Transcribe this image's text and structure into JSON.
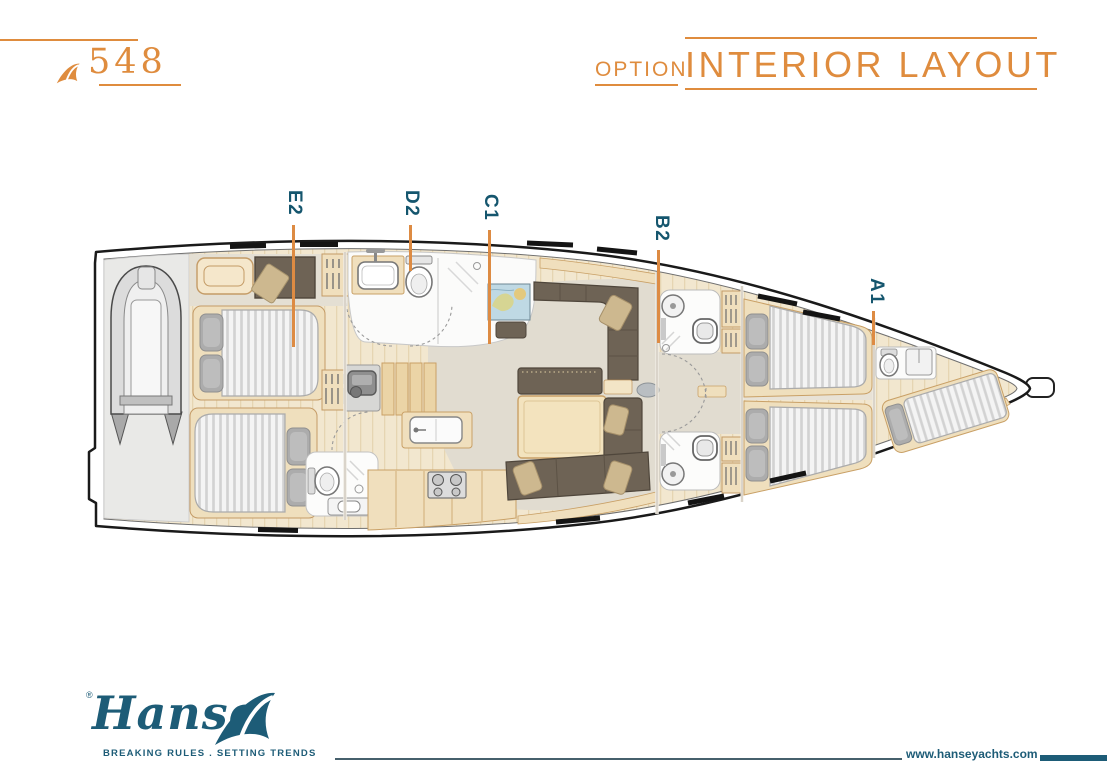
{
  "header": {
    "model": "548",
    "option_label": "OPTION",
    "title": "INTERIOR LAYOUT"
  },
  "plan": {
    "cabin_labels": [
      {
        "code": "E2"
      },
      {
        "code": "D2"
      },
      {
        "code": "C1"
      },
      {
        "code": "B2"
      },
      {
        "code": "A1"
      }
    ]
  },
  "footer": {
    "brand": "Hanse",
    "registered_mark": "®",
    "tagline": "BREAKING RULES . SETTING TRENDS",
    "website": "www.hanseyachts.com"
  },
  "colors": {
    "accent_orange": "#DF8C3E",
    "leader_orange": "#DD8B43",
    "brand_teal": "#1D5C77",
    "label_teal": "#15566E",
    "hull_outline": "#1A1A1A",
    "wood_light": "#F2E7CF",
    "cabinet_wood": "#F0DFBD",
    "sofa_brown": "#6E6355",
    "floor_greige": "#E1DCD0",
    "mattress_gray": "#D2D2D2",
    "pillow_gray": "#ACACAC",
    "garage_gray": "#E9E9E7"
  },
  "icons": {
    "brand_wave": "wave-icon"
  }
}
